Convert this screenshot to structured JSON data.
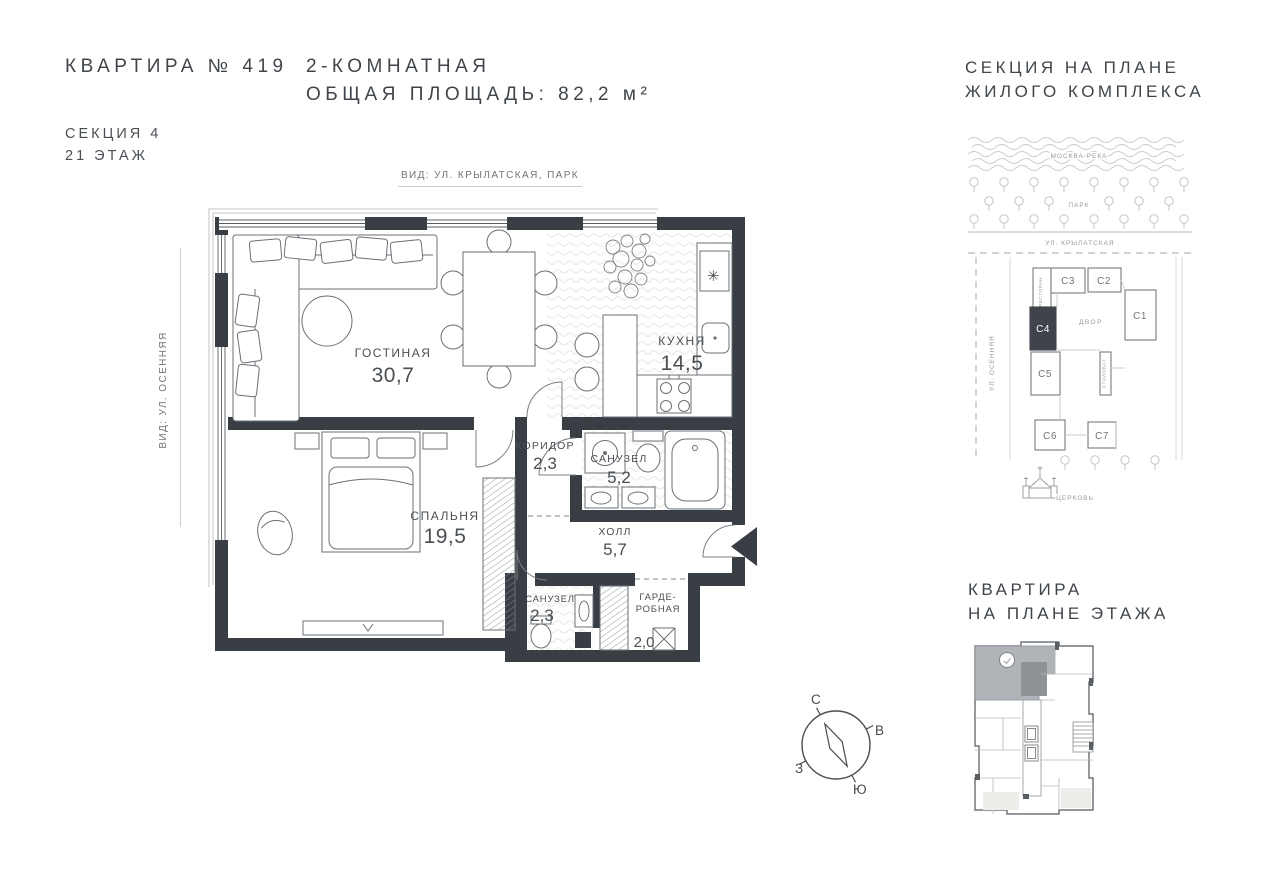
{
  "header": {
    "apartment_title": "КВАРТИРА № 419",
    "type_line": "2-КОМНАТНАЯ",
    "area_line": "ОБЩАЯ ПЛОЩАДЬ: 82,2 м²",
    "section_line": "СЕКЦИЯ 4",
    "floor_line": "21 ЭТАЖ"
  },
  "plan": {
    "view_top_label": "ВИД: УЛ. КРЫЛАТСКАЯ, ПАРК",
    "view_left_label": "ВИД: УЛ. ОСЕННЯЯ",
    "rooms": {
      "living": {
        "label": "ГОСТИНАЯ",
        "area": "30,7"
      },
      "kitchen": {
        "label": "КУХНЯ",
        "area": "14,5"
      },
      "corridor": {
        "label": "КОРИДОР",
        "area": "2,3"
      },
      "bathroom_big": {
        "label": "САНУЗЕЛ",
        "area": "5,2"
      },
      "bedroom": {
        "label": "СПАЛЬНЯ",
        "area": "19,5"
      },
      "hall": {
        "label": "ХОЛЛ",
        "area": "5,7"
      },
      "bathroom_small": {
        "label": "САНУЗЕЛ",
        "area": "2,3"
      },
      "wardrobe": {
        "label_line1": "ГАРДЕ-",
        "label_line2": "РОБНАЯ",
        "area": "2,0"
      }
    },
    "icons": {
      "fridge_star": "✳"
    }
  },
  "site_plan": {
    "title_line1": "СЕКЦИЯ НА ПЛАНЕ",
    "title_line2": "ЖИЛОГО КОМПЛЕКСА",
    "river_label": "МОСКВА РЕКА",
    "park_label": "ПАРК",
    "street_top_label": "УЛ. КРЫЛАТСКАЯ",
    "street_left_label": "УЛ. ОСЕННЯЯ",
    "courtyard_label": "ДВОР",
    "restaurant_label": "РЕСТОРАН",
    "stylobate_label": "СТИЛОБАТ",
    "church_label": "ЦЕРКОВЬ",
    "sections": {
      "c1": "С1",
      "c2": "С2",
      "c3": "С3",
      "c4": "С4",
      "c5": "С5",
      "c6": "С6",
      "c7": "С7"
    },
    "highlighted_section": "С4"
  },
  "compass": {
    "north": "С",
    "east": "В",
    "west": "З",
    "south": "Ю"
  },
  "floor_map": {
    "title_line1": "КВАРТИРА",
    "title_line2": "НА ПЛАНЕ ЭТАЖА"
  },
  "colors": {
    "wall": "#383e44",
    "text_dark": "#3f454a",
    "text_soft": "#6f747a",
    "line_light": "#c6c6c2",
    "highlight_fill": "#b0b4b8",
    "section_dark": "#3e444a"
  }
}
